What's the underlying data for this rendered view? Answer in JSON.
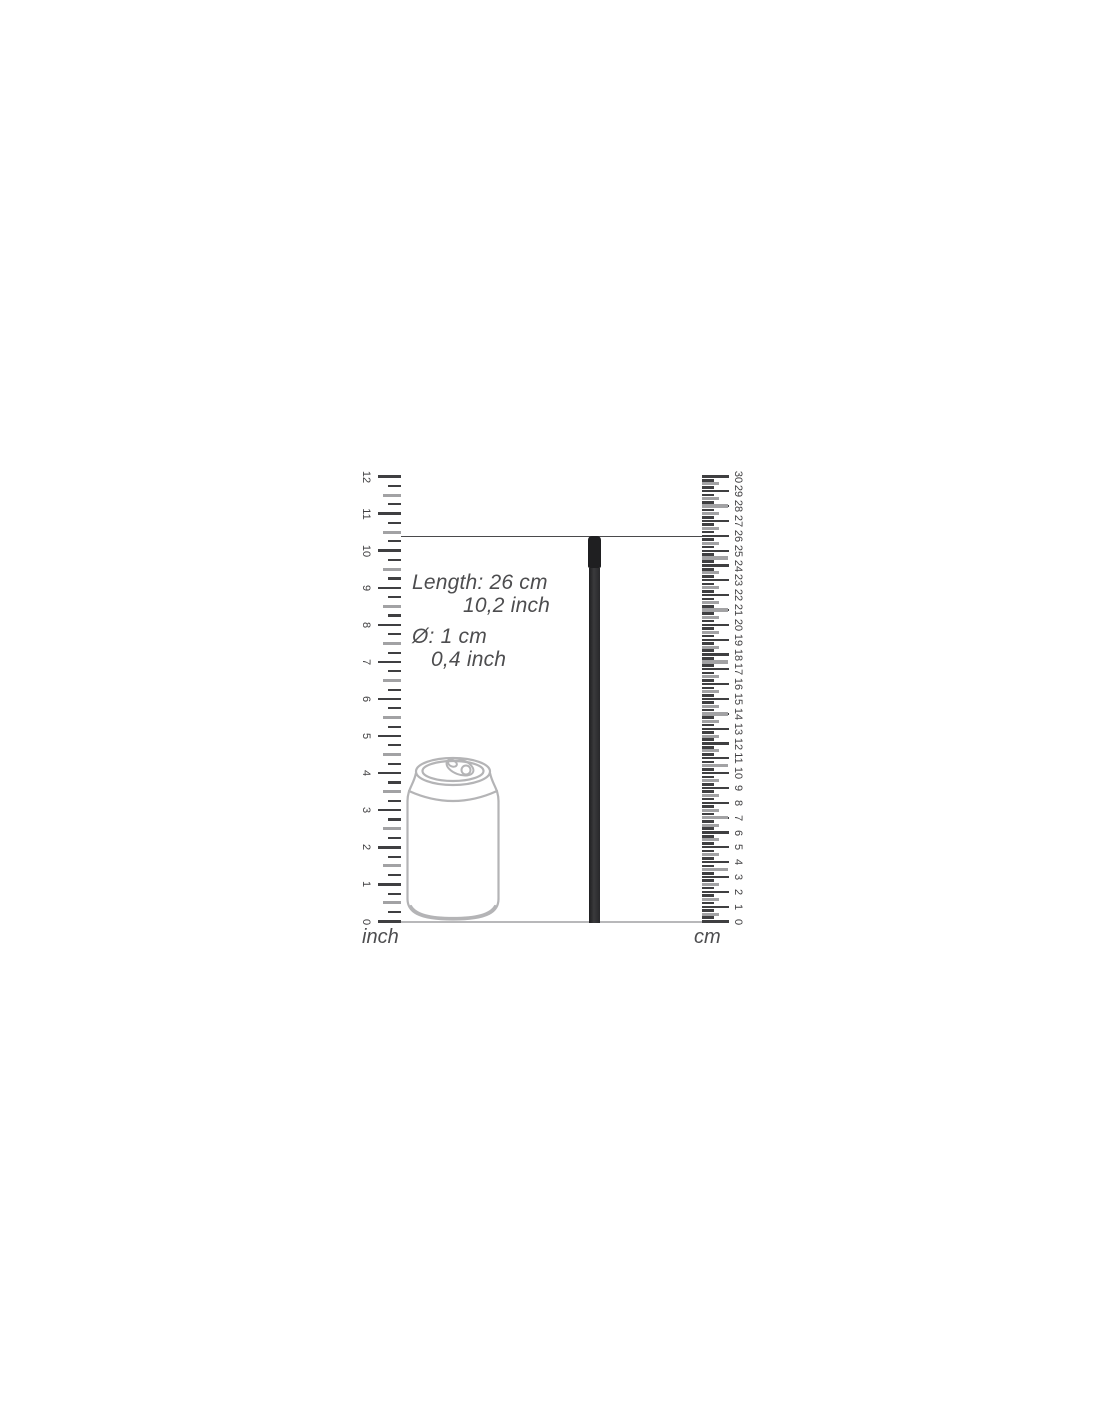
{
  "diagram": {
    "annotations": {
      "length_cm": "Length: 26 cm",
      "length_inch": "10,2 inch",
      "diameter_cm": "Ø: 1 cm",
      "diameter_inch": "0,4 inch"
    },
    "rulers": {
      "inch": {
        "label": "inch",
        "min": 0,
        "max": 12
      },
      "cm": {
        "label": "cm",
        "min": 0,
        "max": 30
      }
    },
    "product": {
      "description": "thin black rod shown at actual size between rulers",
      "length_cm": 26,
      "length_inch": 10.2,
      "diameter_cm": 1,
      "diameter_inch": 0.4
    },
    "reference_object": "beverage can outline drawing",
    "colors": {
      "tick_dark": "#3f3f41",
      "tick_gray": "#a2a2a4",
      "number": "#414042",
      "indicator_line": "#4a4a4c",
      "baseline": "#b8b8ba",
      "can_outline": "#b4b4b6",
      "text": "#4d4d4f",
      "rod_dark": "#1f1f21",
      "rod_mid": "#3a3a3c"
    }
  }
}
